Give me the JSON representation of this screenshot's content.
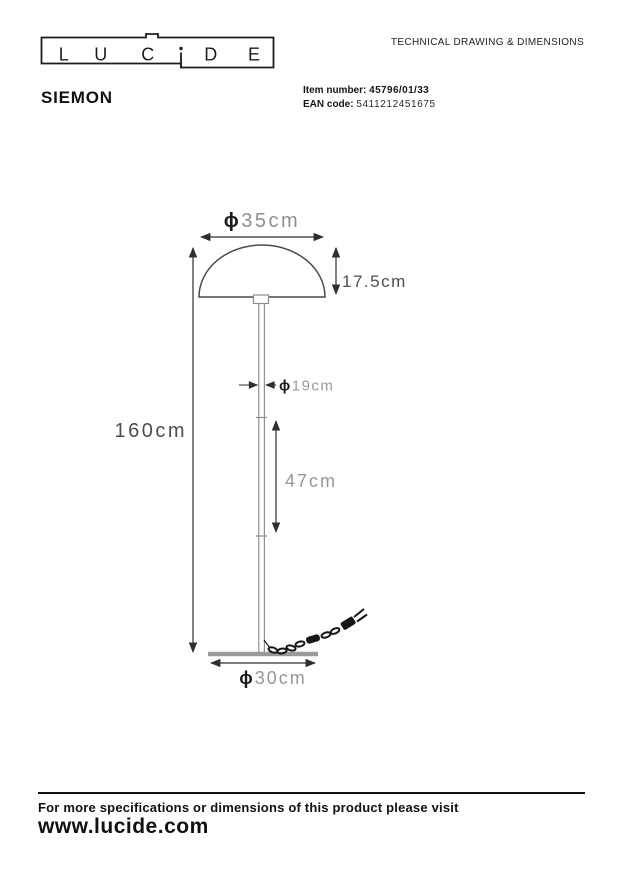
{
  "header": {
    "logo": {
      "name": "LUCIDE",
      "letters": {
        "l1": "L",
        "l2": "U",
        "l3": "C",
        "l4": "i",
        "l5": "D",
        "l6": "E"
      }
    },
    "doc_title": "TECHNICAL DRAWING & DIMENSIONS"
  },
  "product": {
    "name": "SIEMON",
    "item_number_label": "Item number:",
    "item_number": "45796/01/33",
    "ean_label": "EAN code:",
    "ean_code": "5411212451675"
  },
  "drawing": {
    "subject": "floor lamp with dome shade, pole, round base and power cord with plug",
    "dia_symbol": "ϕ",
    "shade_diameter": "35cm",
    "shade_height": "17.5cm",
    "total_height": "160cm",
    "pole_diameter": "19cm",
    "pole_section_height": "47cm",
    "base_diameter": "30cm"
  },
  "footer": {
    "note": "For more specifications or dimensions of this product please visit",
    "website": "www.lucide.com"
  },
  "colors": {
    "ink": "#111111",
    "dimension_line": "#2f2f2f",
    "light_grey_text": "#979797",
    "dark_grey_text": "#4d4d4d",
    "drawing_grey": "#909090"
  }
}
